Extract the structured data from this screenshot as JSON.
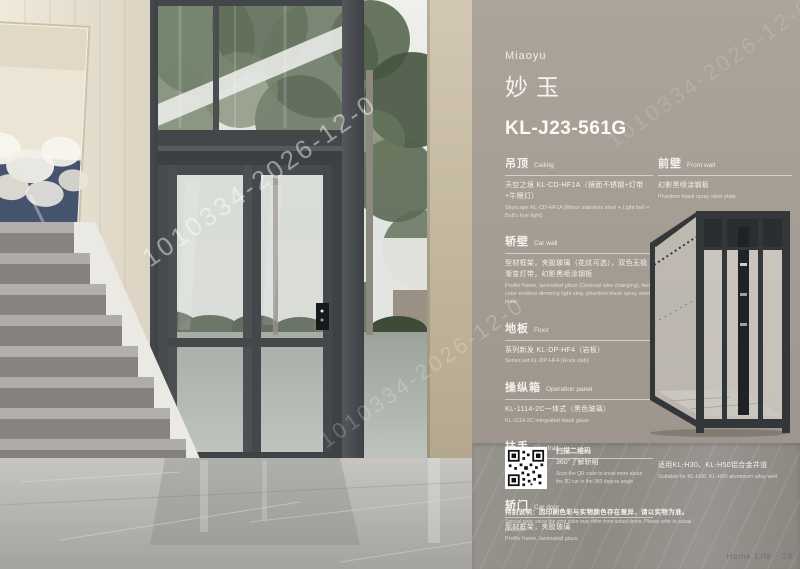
{
  "photo": {
    "description": "home glass elevator in a residence with marble stairs and garden view",
    "watermark": "1010334-2026-12-0"
  },
  "panel": {
    "brand_en": "Miaoyu",
    "brand_cn": "妙玉",
    "model": "KL-J23-561G",
    "accent_text_color": "#f4f2ed",
    "wall_color": "#a59d93",
    "sections_left": [
      {
        "title_cn": "吊顶",
        "title_en": "Ceiling",
        "body_cn": "天空之境 KL-CD-HF1A（镜面不锈钢+灯带+牛眼灯）",
        "body_en": "Skyscape KL-CD-HF1A (Mirror stainless steel + Light belt + Bull's Eye light)"
      },
      {
        "title_cn": "轿壁",
        "title_en": "Car wall",
        "body_cn": "型材框架，夹胶玻璃（花纹可选），双色无极渐变灯带，幻影黑喷涂钢板",
        "body_en": "Profile frame, laminated glass (Optional wire changing), two-color endless dimming light strip, phantom black spray steel plate"
      },
      {
        "title_cn": "地板",
        "title_en": "Floor",
        "body_cn": "系列新发 KL-DP-HF4（岩板）",
        "body_en": "Series set KL-DP-HF4 (Rock slab)"
      },
      {
        "title_cn": "操纵箱",
        "title_en": "Operation panel",
        "body_cn": "KL-1114-2C一体式（黑色玻璃）",
        "body_en": "KL-1114-2C integrated black glass"
      },
      {
        "title_cn": "扶手",
        "title_en": "Handrail",
        "body_cn": "可选配",
        "body_en": "Optional"
      },
      {
        "title_cn": "轿门",
        "title_en": "Car door",
        "body_cn": "型材框架，夹胶玻璃",
        "body_en": "Profile frame, laminated glass"
      }
    ],
    "sections_right": [
      {
        "title_cn": "前壁",
        "title_en": "Front wall",
        "body_cn": "幻影黑喷涂钢板",
        "body_en": "Phantom black spray steel plate"
      }
    ],
    "qr": {
      "caption_cn1": "扫描二维码",
      "caption_cn2": "360°了解轿厢",
      "caption_en": "Scan the QR code to know more about the 3D car in the 360 degree angle"
    },
    "suitable_cn": "适用KL-H30、KL-H50铝合金井道",
    "suitable_en": "Suitable for KL-H30, KL-H50 aluminum alloy well",
    "note_cn": "特别说明：因印刷色彩与实物颜色存在差异，请以实物为准。",
    "note_en": "Special note: since the print color may differ from actual items. Please refer to actual products.",
    "footer": "Home Life · 28"
  }
}
